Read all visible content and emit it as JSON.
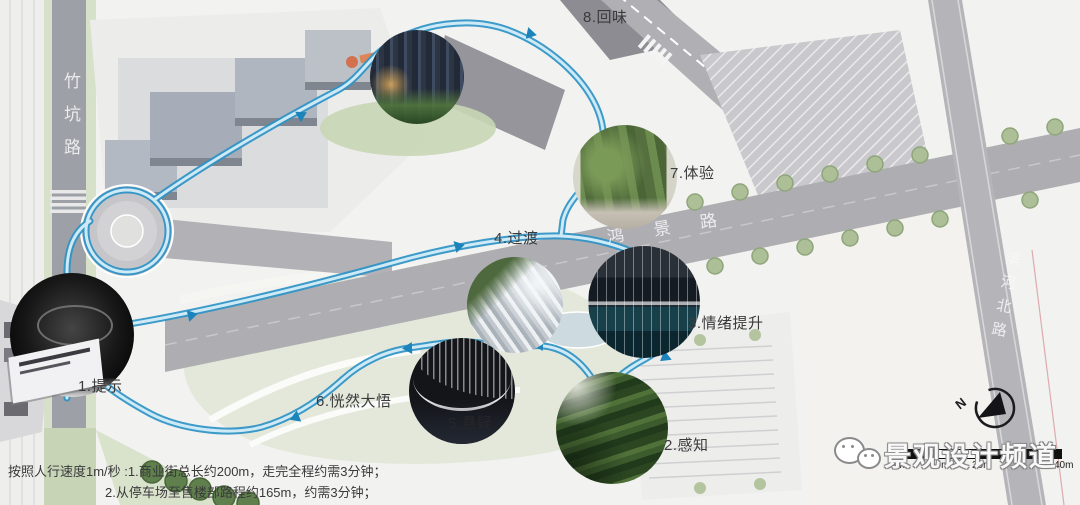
{
  "roads": {
    "left": "竹坑路",
    "middle": "鸿景路",
    "right": "滨河北路"
  },
  "stops": [
    {
      "text": "1.提示"
    },
    {
      "text": "2.感知"
    },
    {
      "text": "3.情绪提升"
    },
    {
      "text": "4.过渡"
    },
    {
      "text": "5.悬疑"
    },
    {
      "text": "6.恍然大悟"
    },
    {
      "text": "7.体验"
    },
    {
      "text": "8.回味"
    }
  ],
  "notes": {
    "line1": "按照人行速度1m/秒 :1.商业街总长约200m，走完全程约需3分钟；",
    "line2": "2.从停车场至售楼部路程约165m，约需3分钟；"
  },
  "scalebar": {
    "labels": [
      "0m",
      "10m",
      "20m",
      "40m"
    ]
  },
  "compass": {
    "label": "N"
  },
  "watermark": {
    "text": "景观设计频道"
  },
  "colors": {
    "route": "#2e93c6",
    "route_inner": "#cdeaf6",
    "road": "#aeaeb2"
  }
}
